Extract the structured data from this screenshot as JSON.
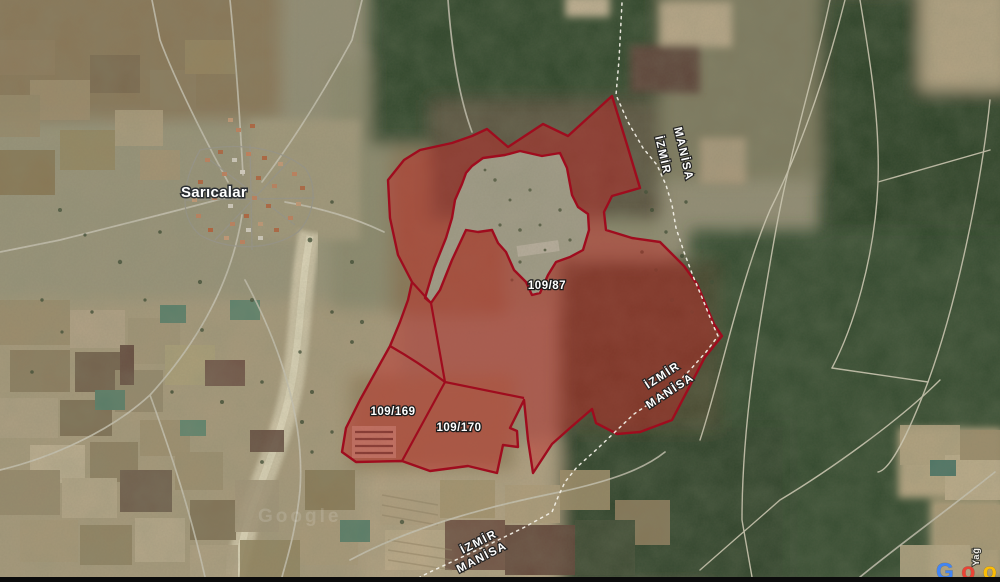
{
  "map_labels": {
    "village": "Sarıcalar",
    "parcel_87": "109/87",
    "parcel_169": "109/169",
    "parcel_170": "109/170",
    "boundary_top": {
      "line1": "MANİSA",
      "line2": "İZMİR"
    },
    "boundary_mid": {
      "line1": "İZMİR",
      "line2": "MANİSA"
    },
    "boundary_bottom": {
      "line1": "İZMİR",
      "line2": "MANİSA"
    },
    "road_vertical": "Yağ",
    "watermark": "Google"
  },
  "logo": {
    "letters": [
      {
        "ch": "G",
        "color": "#4285F4"
      },
      {
        "ch": "o",
        "color": "#EA4335"
      },
      {
        "ch": "o",
        "color": "#FBBC05"
      },
      {
        "ch": "g",
        "color": "#4285F4"
      },
      {
        "ch": "l",
        "color": "#34A853"
      },
      {
        "ch": "e",
        "color": "#EA4335"
      }
    ]
  },
  "colors": {
    "parcel_fill": "rgba(197,34,34,0.44)",
    "parcel_stroke": "#9f0c1e",
    "province_dash": "#f2efe6",
    "label_text": "#ffffff"
  }
}
